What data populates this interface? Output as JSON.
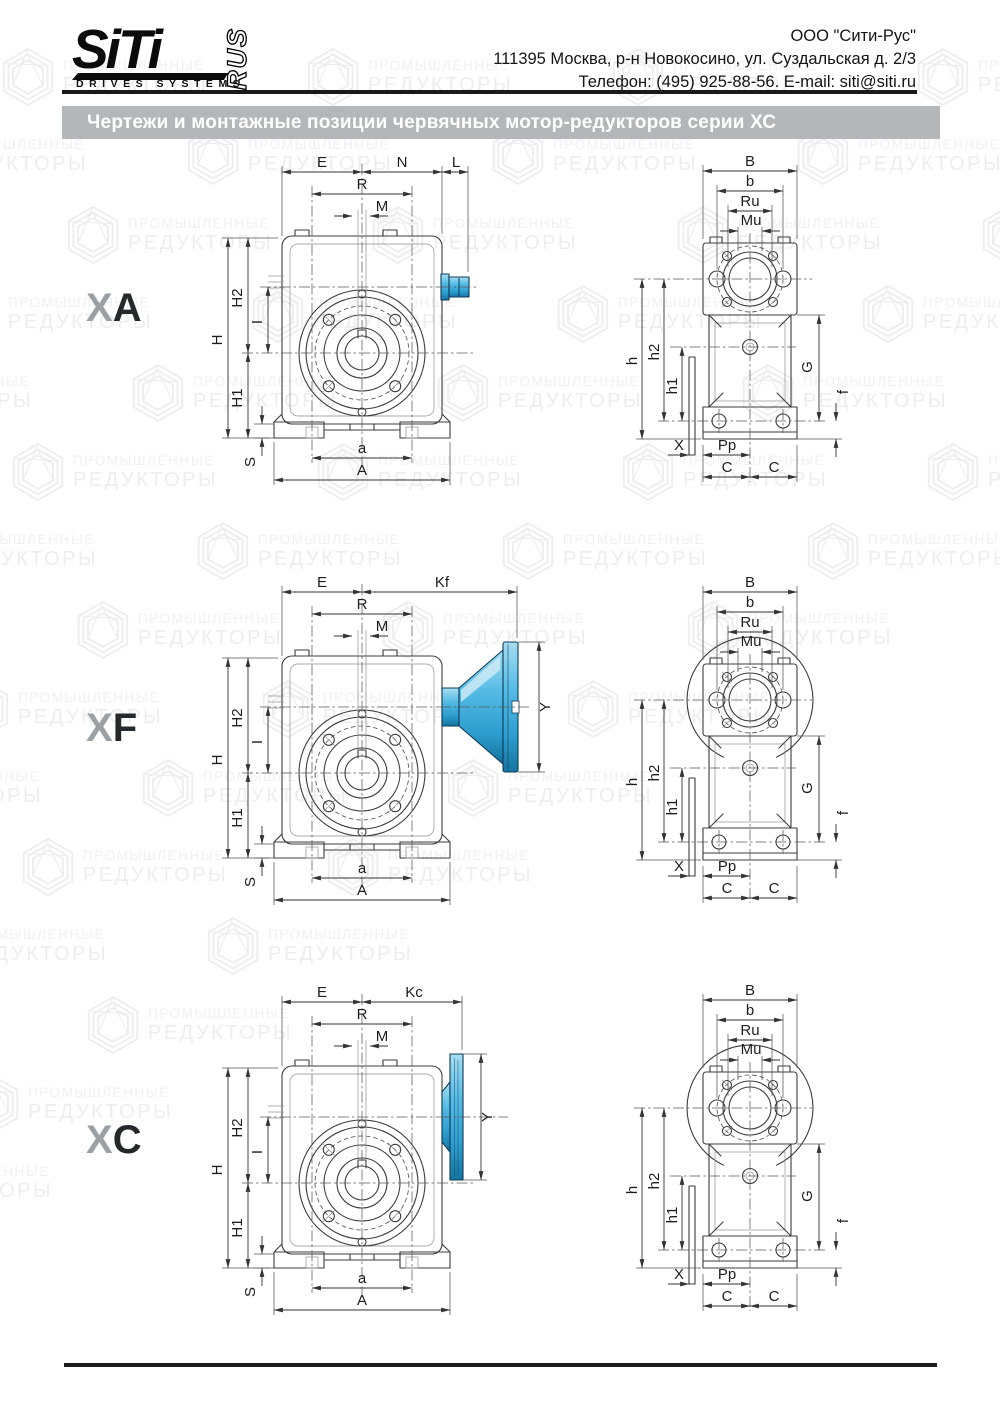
{
  "page": {
    "width": 1000,
    "height": 1414
  },
  "header": {
    "logo": {
      "brand": "SiTi",
      "suffix": "RUS",
      "tagline": "DRIVES SYSTEMS"
    },
    "company_lines": [
      "ООО \"Сити-Рус\"",
      "111395 Москва, р-н Новокосино, ул. Суздальская д. 2/3",
      "Телефон: (495) 925-88-56. E-mail: siti@siti.ru"
    ]
  },
  "title_bar": {
    "text": "Чертежи и монтажные позиции червячных мотор-редукторов серии ХС",
    "bg_color": "#b4b7b9",
    "text_color": "#ffffff"
  },
  "watermark": {
    "line1": "ПРОМЫШЛЕННЫЕ",
    "line2": "РЕДУКТОРЫ",
    "color": "#efefef"
  },
  "colors": {
    "accent_blue": "#45b0de",
    "accent_blue_dark": "#0e3b58",
    "line": "#3c3c3c",
    "title_gray": "#b4b7b9"
  },
  "variants": [
    {
      "id": "XA",
      "label_prefix": "X",
      "label_letter": "A",
      "front_dims": {
        "E": "E",
        "N": "N",
        "L": "L",
        "R": "R",
        "M": "M",
        "H": "H",
        "H2": "H2",
        "I": "I",
        "H1": "H1",
        "S": "S",
        "a": "a",
        "A": "A"
      },
      "side_dims": {
        "B": "B",
        "b": "b",
        "Ru": "Ru",
        "Mu": "Mu",
        "h": "h",
        "h2": "h2",
        "h1": "h1",
        "G": "G",
        "f": "f",
        "X": "X",
        "Pp": "Pp",
        "C_left": "C",
        "C_right": "C"
      }
    },
    {
      "id": "XF",
      "label_prefix": "X",
      "label_letter": "F",
      "front_dims": {
        "E": "E",
        "Kf": "Kf",
        "R": "R",
        "M": "M",
        "H": "H",
        "H2": "H2",
        "I": "I",
        "H1": "H1",
        "S": "S",
        "a": "a",
        "A": "A",
        "Y": "Y"
      },
      "side_dims": {
        "B": "B",
        "b": "b",
        "Ru": "Ru",
        "Mu": "Mu",
        "h": "h",
        "h2": "h2",
        "h1": "h1",
        "G": "G",
        "f": "f",
        "X": "X",
        "Pp": "Pp",
        "C_left": "C",
        "C_right": "C"
      }
    },
    {
      "id": "XC",
      "label_prefix": "X",
      "label_letter": "C",
      "front_dims": {
        "E": "E",
        "Kc": "Kc",
        "R": "R",
        "M": "M",
        "H": "H",
        "H2": "H2",
        "I": "I",
        "H1": "H1",
        "S": "S",
        "a": "a",
        "A": "A",
        "Y": "Y"
      },
      "side_dims": {
        "B": "B",
        "b": "b",
        "Ru": "Ru",
        "Mu": "Mu",
        "h": "h",
        "h2": "h2",
        "h1": "h1",
        "G": "G",
        "f": "f",
        "X": "X",
        "Pp": "Pp",
        "C_left": "C",
        "C_right": "C"
      }
    }
  ]
}
